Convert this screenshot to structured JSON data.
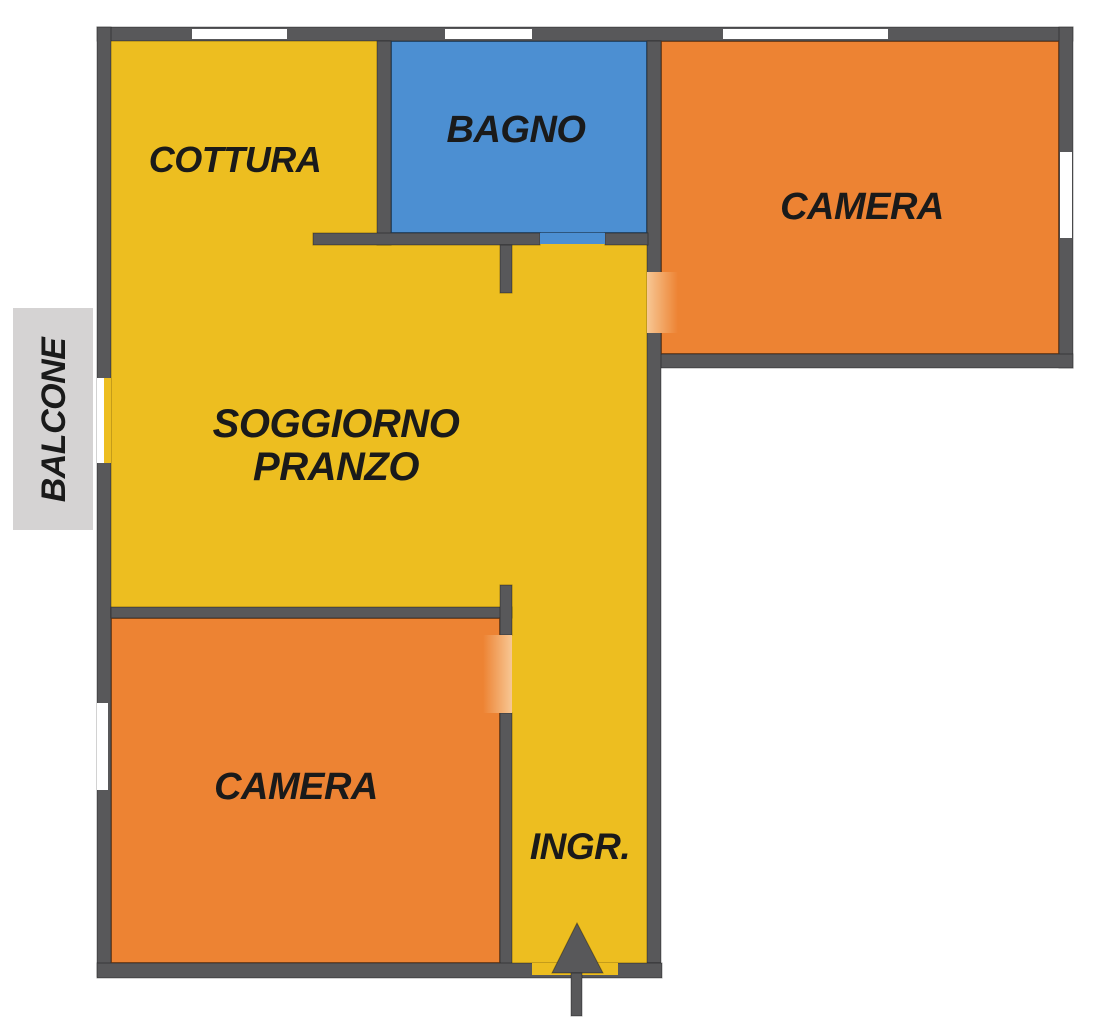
{
  "plan": {
    "rooms": {
      "cottura": {
        "label": "COTTURA"
      },
      "bagno": {
        "label": "BAGNO"
      },
      "camera_top": {
        "label": "CAMERA"
      },
      "soggiorno": {
        "label_line1": "SOGGIORNO",
        "label_line2": "PRANZO"
      },
      "camera_bottom": {
        "label": "CAMERA"
      },
      "ingresso": {
        "label": "INGR."
      },
      "balcone": {
        "label": "BALCONE"
      }
    },
    "colors": {
      "floor_yellow": "#edbe20",
      "floor_orange": "#ed8333",
      "floor_blue": "#4c8fd2",
      "wall_gray": "#58585a",
      "balcony_gray": "#d5d3d3",
      "door_highlight": "#f7c794",
      "window_white": "#ffffff",
      "label_text": "#1a1a1a"
    }
  }
}
